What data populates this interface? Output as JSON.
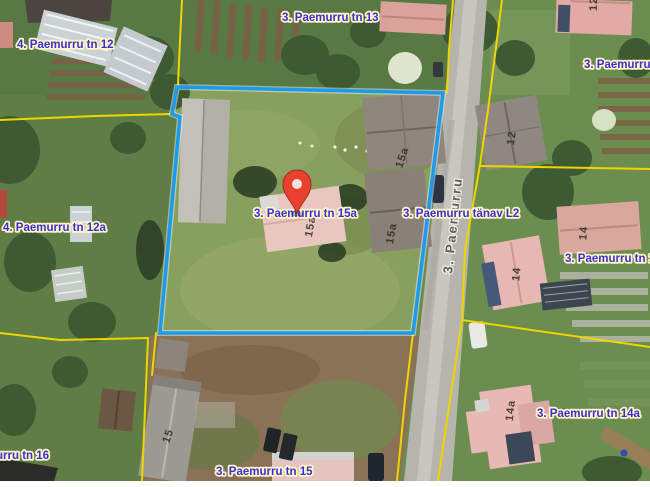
{
  "map": {
    "address_labels": {
      "tn12": "4. Paemurru tn 12",
      "tn13": "3. Paemurru tn 13",
      "tn12_right_truncated": "3. Paemurru tn",
      "tn12a": "4. Paemurru tn 12a",
      "tn15a": "3. Paemurru tn 15a",
      "tanav_l2": "3. Paemurru tänav L2",
      "tn14": "3. Paemurru tn 14",
      "tn14a": "3. Paemurru tn 14a",
      "tn15": "3. Paemurru tn 15",
      "tn16_truncated": "urru tn 16"
    },
    "street_name": "3. Paemurru",
    "building_numbers": {
      "house_15a_main": "15a",
      "house_15a_upper": "15a",
      "house_15a_lower": "15a",
      "house_15": "15",
      "house_12": "12",
      "house_12_top": "12",
      "house_14": "14",
      "house_14_right": "14",
      "house_14a": "14a"
    },
    "colors": {
      "parcel_outline": "#1b9bf0",
      "cadastral_line": "#f0d400",
      "label_text": "#3b2ed6",
      "label_halo": "#fdf5c4",
      "marker_red": "#e94130"
    }
  }
}
